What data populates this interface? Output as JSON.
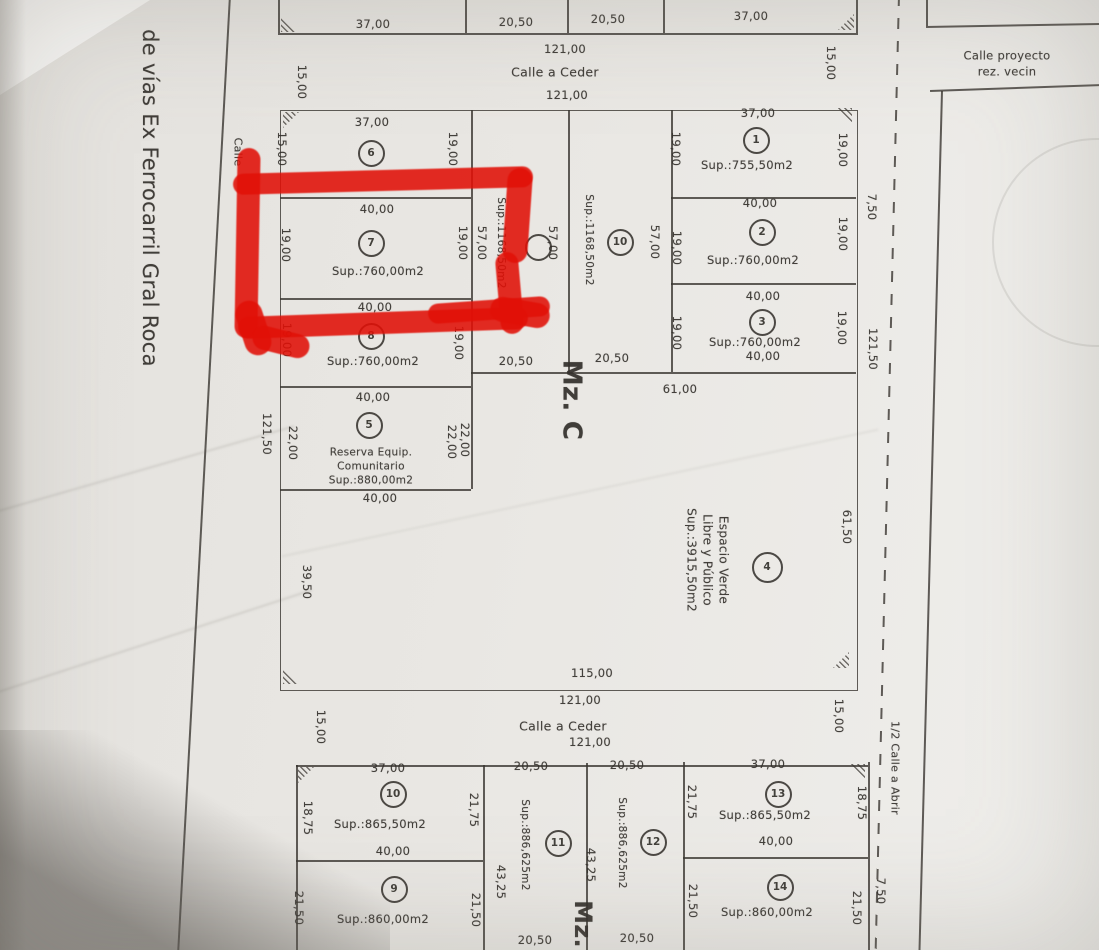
{
  "colors": {
    "paper": "#e9e7e3",
    "ink": "#3a3632",
    "highlight_red": "#e11007"
  },
  "plan": {
    "labels": [
      {
        "t": "37,00",
        "x": 373,
        "y": 25
      },
      {
        "t": "20,50",
        "x": 516,
        "y": 23
      },
      {
        "t": "20,50",
        "x": 608,
        "y": 20
      },
      {
        "t": "37,00",
        "x": 751,
        "y": 17
      },
      {
        "t": "15,00",
        "x": 301,
        "y": 82,
        "r": 90
      },
      {
        "t": "15,00",
        "x": 830,
        "y": 63,
        "r": 90
      },
      {
        "t": "121,00",
        "x": 565,
        "y": 50
      },
      {
        "t": "Calle a Ceder",
        "x": 555,
        "y": 73,
        "s": 12.5,
        "nm": "street-name"
      },
      {
        "t": "121,00",
        "x": 567,
        "y": 96
      },
      {
        "t": "37,00",
        "x": 372,
        "y": 123
      },
      {
        "t": "15,00",
        "x": 281,
        "y": 149,
        "r": 90
      },
      {
        "t": "19,00",
        "x": 452,
        "y": 149,
        "r": 90
      },
      {
        "t": "40,00",
        "x": 377,
        "y": 210
      },
      {
        "t": "Sup.:760,00m2",
        "x": 378,
        "y": 272,
        "nm": "lot-area-label"
      },
      {
        "t": "19,00",
        "x": 285,
        "y": 245,
        "r": 90
      },
      {
        "t": "19,00",
        "x": 462,
        "y": 243,
        "r": 90
      },
      {
        "t": "40,00",
        "x": 375,
        "y": 308
      },
      {
        "t": "Sup.:760,00m2",
        "x": 373,
        "y": 362,
        "nm": "lot-area-label"
      },
      {
        "t": "19,00",
        "x": 286,
        "y": 340,
        "r": 90
      },
      {
        "t": "19,00",
        "x": 458,
        "y": 343,
        "r": 90
      },
      {
        "t": "40,00",
        "x": 373,
        "y": 398
      },
      {
        "t": "Reserva Equip.\nComunitario\nSup.:880,00m2",
        "x": 371,
        "y": 467,
        "s": 10.5,
        "nm": "reserva-label"
      },
      {
        "t": "22,00",
        "x": 292,
        "y": 443,
        "r": 90
      },
      {
        "t": "22,00",
        "x": 451,
        "y": 442,
        "r": 90
      },
      {
        "t": "22,00",
        "x": 464,
        "y": 440,
        "r": 90
      },
      {
        "t": "40,00",
        "x": 380,
        "y": 499
      },
      {
        "t": "121,50",
        "x": 266,
        "y": 434,
        "r": 90
      },
      {
        "t": "39,50",
        "x": 306,
        "y": 582,
        "r": 90
      },
      {
        "t": "57,00",
        "x": 481,
        "y": 243,
        "r": 90
      },
      {
        "t": "Sup.:1168,50m2",
        "x": 501,
        "y": 243,
        "r": 90,
        "s": 10.5,
        "nm": "lot-area-label"
      },
      {
        "t": "57,00",
        "x": 552,
        "y": 243,
        "r": 90
      },
      {
        "t": "Sup.:1168,50m2",
        "x": 589,
        "y": 240,
        "r": 90,
        "s": 10.5,
        "nm": "lot-area-label"
      },
      {
        "t": "57,00",
        "x": 654,
        "y": 242,
        "r": 90
      },
      {
        "t": "20,50",
        "x": 516,
        "y": 362
      },
      {
        "t": "20,50",
        "x": 612,
        "y": 359
      },
      {
        "t": "Mz. C",
        "x": 571,
        "y": 400,
        "r": 90,
        "s": 26,
        "b": 1,
        "nm": "manzana-label"
      },
      {
        "t": "61,00",
        "x": 680,
        "y": 390
      },
      {
        "t": "37,00",
        "x": 758,
        "y": 114
      },
      {
        "t": "Sup.:755,50m2",
        "x": 747,
        "y": 166,
        "nm": "lot-area-label"
      },
      {
        "t": "19,00",
        "x": 675,
        "y": 149,
        "r": 90
      },
      {
        "t": "19,00",
        "x": 842,
        "y": 150,
        "r": 90
      },
      {
        "t": "40,00",
        "x": 760,
        "y": 204
      },
      {
        "t": "Sup.:760,00m2",
        "x": 753,
        "y": 261,
        "nm": "lot-area-label"
      },
      {
        "t": "19,00",
        "x": 676,
        "y": 248,
        "r": 90
      },
      {
        "t": "19,00",
        "x": 842,
        "y": 234,
        "r": 90
      },
      {
        "t": "40,00",
        "x": 763,
        "y": 297
      },
      {
        "t": "Sup.:760,00m2",
        "x": 755,
        "y": 343,
        "nm": "lot-area-label"
      },
      {
        "t": "19,00",
        "x": 676,
        "y": 333,
        "r": 90
      },
      {
        "t": "19,00",
        "x": 841,
        "y": 328,
        "r": 90
      },
      {
        "t": "40,00",
        "x": 763,
        "y": 357
      },
      {
        "t": "Espacio Verde\nLibre y Público\nSup.:3915,50m2",
        "x": 707,
        "y": 560,
        "r": 90,
        "s": 12,
        "nm": "espacio-verde-label"
      },
      {
        "t": "61,50",
        "x": 846,
        "y": 527,
        "r": 90
      },
      {
        "t": "115,00",
        "x": 592,
        "y": 674
      },
      {
        "t": "121,00",
        "x": 580,
        "y": 701
      },
      {
        "t": "Calle a Ceder",
        "x": 563,
        "y": 727,
        "s": 12.5,
        "nm": "street-name"
      },
      {
        "t": "121,00",
        "x": 590,
        "y": 743
      },
      {
        "t": "15,00",
        "x": 320,
        "y": 727,
        "r": 90
      },
      {
        "t": "15,00",
        "x": 838,
        "y": 716,
        "r": 90
      },
      {
        "t": "7,50",
        "x": 871,
        "y": 207,
        "r": 90
      },
      {
        "t": "121,50",
        "x": 872,
        "y": 349,
        "r": 90
      },
      {
        "t": "1/2 Calle a Abrir",
        "x": 894,
        "y": 768,
        "r": 90,
        "s": 11,
        "nm": "street-name"
      },
      {
        "t": "18,75",
        "x": 861,
        "y": 803,
        "r": 90
      },
      {
        "t": "21,50",
        "x": 856,
        "y": 908,
        "r": 90
      },
      {
        "t": "7,50",
        "x": 880,
        "y": 891,
        "r": 90
      },
      {
        "t": "Calle proyecto rez. vecin",
        "x": 1007,
        "y": 64,
        "s": 11.5,
        "nm": "street-name"
      },
      {
        "t": "37,00",
        "x": 388,
        "y": 769
      },
      {
        "t": "Sup.:865,50m2",
        "x": 380,
        "y": 825,
        "nm": "lot-area-label"
      },
      {
        "t": "40,00",
        "x": 393,
        "y": 852
      },
      {
        "t": "18,75",
        "x": 307,
        "y": 818,
        "r": 90
      },
      {
        "t": "21,75",
        "x": 473,
        "y": 810,
        "r": 90
      },
      {
        "t": "Sup.:860,00m2",
        "x": 383,
        "y": 920,
        "nm": "lot-area-label"
      },
      {
        "t": "21,50",
        "x": 298,
        "y": 908,
        "r": 90
      },
      {
        "t": "21,50",
        "x": 475,
        "y": 910,
        "r": 90
      },
      {
        "t": "20,50",
        "x": 531,
        "y": 767
      },
      {
        "t": "20,50",
        "x": 627,
        "y": 766
      },
      {
        "t": "Sup.:886,625m2",
        "x": 525,
        "y": 845,
        "r": 90,
        "s": 10.5,
        "nm": "lot-area-label"
      },
      {
        "t": "43,25",
        "x": 500,
        "y": 882,
        "r": 90
      },
      {
        "t": "43,25",
        "x": 590,
        "y": 865,
        "r": 90
      },
      {
        "t": "Sup.:886,625m2",
        "x": 622,
        "y": 843,
        "r": 90,
        "s": 10.5,
        "nm": "lot-area-label"
      },
      {
        "t": "Mz.",
        "x": 583,
        "y": 924,
        "r": 90,
        "s": 24,
        "b": 1,
        "nm": "manzana-label"
      },
      {
        "t": "20,50",
        "x": 535,
        "y": 941
      },
      {
        "t": "20,50",
        "x": 637,
        "y": 939
      },
      {
        "t": "37,00",
        "x": 768,
        "y": 765
      },
      {
        "t": "Sup.:865,50m2",
        "x": 765,
        "y": 816,
        "nm": "lot-area-label"
      },
      {
        "t": "40,00",
        "x": 776,
        "y": 842
      },
      {
        "t": "21,75",
        "x": 691,
        "y": 802,
        "r": 90
      },
      {
        "t": "Sup.:860,00m2",
        "x": 767,
        "y": 913,
        "nm": "lot-area-label"
      },
      {
        "t": "21,50",
        "x": 692,
        "y": 901,
        "r": 90
      },
      {
        "t": "de vías Ex Ferrocarril Gral Roca",
        "x": 150,
        "y": 198,
        "r": 90,
        "s": 21,
        "nm": "railway-label"
      },
      {
        "t": "Calle",
        "x": 237,
        "y": 152,
        "r": 90,
        "s": 11,
        "nm": "street-name"
      }
    ],
    "lot_circles": [
      {
        "n": "6",
        "x": 371,
        "y": 153
      },
      {
        "n": "7",
        "x": 371,
        "y": 243
      },
      {
        "n": "8",
        "x": 371,
        "y": 336
      },
      {
        "n": "5",
        "x": 369,
        "y": 425
      },
      {
        "n": "",
        "x": 538,
        "y": 247
      },
      {
        "n": "10",
        "x": 620,
        "y": 242
      },
      {
        "n": "1",
        "x": 756,
        "y": 140
      },
      {
        "n": "2",
        "x": 762,
        "y": 232
      },
      {
        "n": "3",
        "x": 762,
        "y": 322
      },
      {
        "n": "4",
        "x": 767,
        "y": 567,
        "d": 31
      },
      {
        "n": "10",
        "x": 393,
        "y": 794
      },
      {
        "n": "9",
        "x": 394,
        "y": 889
      },
      {
        "n": "11",
        "x": 558,
        "y": 843
      },
      {
        "n": "12",
        "x": 653,
        "y": 842
      },
      {
        "n": "13",
        "x": 778,
        "y": 794
      },
      {
        "n": "14",
        "x": 780,
        "y": 887
      }
    ],
    "rects": [
      {
        "x": 280,
        "y": 110,
        "w": 576,
        "h": 579
      }
    ],
    "lines": [
      {
        "o": "h",
        "x": 278,
        "y": 33,
        "len": 580
      },
      {
        "o": "v",
        "x": 278,
        "y": -15,
        "len": 48
      },
      {
        "o": "v",
        "x": 465,
        "y": -15,
        "len": 48
      },
      {
        "o": "v",
        "x": 567,
        "y": -12,
        "len": 45
      },
      {
        "o": "v",
        "x": 663,
        "y": -12,
        "len": 45
      },
      {
        "o": "v",
        "x": 856,
        "y": -8,
        "len": 41
      },
      {
        "o": "v",
        "x": 471,
        "y": 110,
        "len": 379
      },
      {
        "o": "v",
        "x": 568,
        "y": 110,
        "len": 262
      },
      {
        "o": "v",
        "x": 671,
        "y": 110,
        "len": 262
      },
      {
        "o": "h",
        "x": 280,
        "y": 197,
        "len": 191
      },
      {
        "o": "h",
        "x": 671,
        "y": 197,
        "len": 185
      },
      {
        "o": "h",
        "x": 280,
        "y": 298,
        "len": 191
      },
      {
        "o": "h",
        "x": 671,
        "y": 283,
        "len": 185
      },
      {
        "o": "h",
        "x": 471,
        "y": 372,
        "len": 385
      },
      {
        "o": "h",
        "x": 280,
        "y": 386,
        "len": 191
      },
      {
        "o": "h",
        "x": 280,
        "y": 489,
        "len": 191
      },
      {
        "o": "h",
        "x": 296,
        "y": 765,
        "len": 572
      },
      {
        "o": "v",
        "x": 296,
        "y": 765,
        "len": 185
      },
      {
        "o": "v",
        "x": 868,
        "y": 762,
        "len": 188
      },
      {
        "o": "v",
        "x": 483,
        "y": 765,
        "len": 185
      },
      {
        "o": "v",
        "x": 586,
        "y": 763,
        "len": 187
      },
      {
        "o": "v",
        "x": 683,
        "y": 762,
        "len": 188
      },
      {
        "o": "h",
        "x": 296,
        "y": 860,
        "len": 187
      },
      {
        "o": "h",
        "x": 683,
        "y": 857,
        "len": 185
      },
      {
        "o": "v",
        "x": 898,
        "y": -5,
        "len": 960,
        "r": 1.4,
        "dash": 1,
        "nm": "street-centerline"
      },
      {
        "o": "v",
        "x": 229,
        "y": -5,
        "len": 962,
        "r": 3.1,
        "nm": "railway-boundary-line"
      },
      {
        "o": "v",
        "x": 941,
        "y": 91,
        "len": 860,
        "r": 1.5
      },
      {
        "o": "h",
        "x": 930,
        "y": 90,
        "len": 170,
        "r": -2
      },
      {
        "o": "h",
        "x": 926,
        "y": 26,
        "len": 173,
        "r": -1
      },
      {
        "o": "v",
        "x": 926,
        "y": -15,
        "len": 41
      }
    ],
    "hatches": [
      {
        "x": 281,
        "y": 16,
        "c": "bl"
      },
      {
        "x": 838,
        "y": 14,
        "c": "br"
      },
      {
        "x": 283,
        "y": 112,
        "c": "tl"
      },
      {
        "x": 836,
        "y": 108,
        "c": "tr"
      },
      {
        "x": 283,
        "y": 668,
        "c": "bl"
      },
      {
        "x": 833,
        "y": 652,
        "c": "br"
      },
      {
        "x": 298,
        "y": 767,
        "c": "tl"
      },
      {
        "x": 849,
        "y": 764,
        "c": "tr"
      }
    ]
  },
  "annotation": {
    "highlighted_lot": "7",
    "strokes": [
      {
        "x": 233,
        "y": 170,
        "w": 300,
        "h": 21,
        "r": -1.5
      },
      {
        "x": 236,
        "y": 148,
        "w": 23,
        "h": 190,
        "r": 1
      },
      {
        "x": 238,
        "y": 312,
        "w": 290,
        "h": 22,
        "r": -2
      },
      {
        "x": 428,
        "y": 300,
        "w": 122,
        "h": 20,
        "r": -4
      },
      {
        "x": 505,
        "y": 168,
        "w": 25,
        "h": 95,
        "r": 4
      },
      {
        "x": 498,
        "y": 252,
        "w": 23,
        "h": 82,
        "r": -5
      },
      {
        "x": 490,
        "y": 300,
        "w": 60,
        "h": 25,
        "r": 10
      },
      {
        "x": 240,
        "y": 300,
        "w": 27,
        "h": 56,
        "r": -18
      },
      {
        "x": 252,
        "y": 330,
        "w": 58,
        "h": 24,
        "r": 14
      }
    ]
  }
}
